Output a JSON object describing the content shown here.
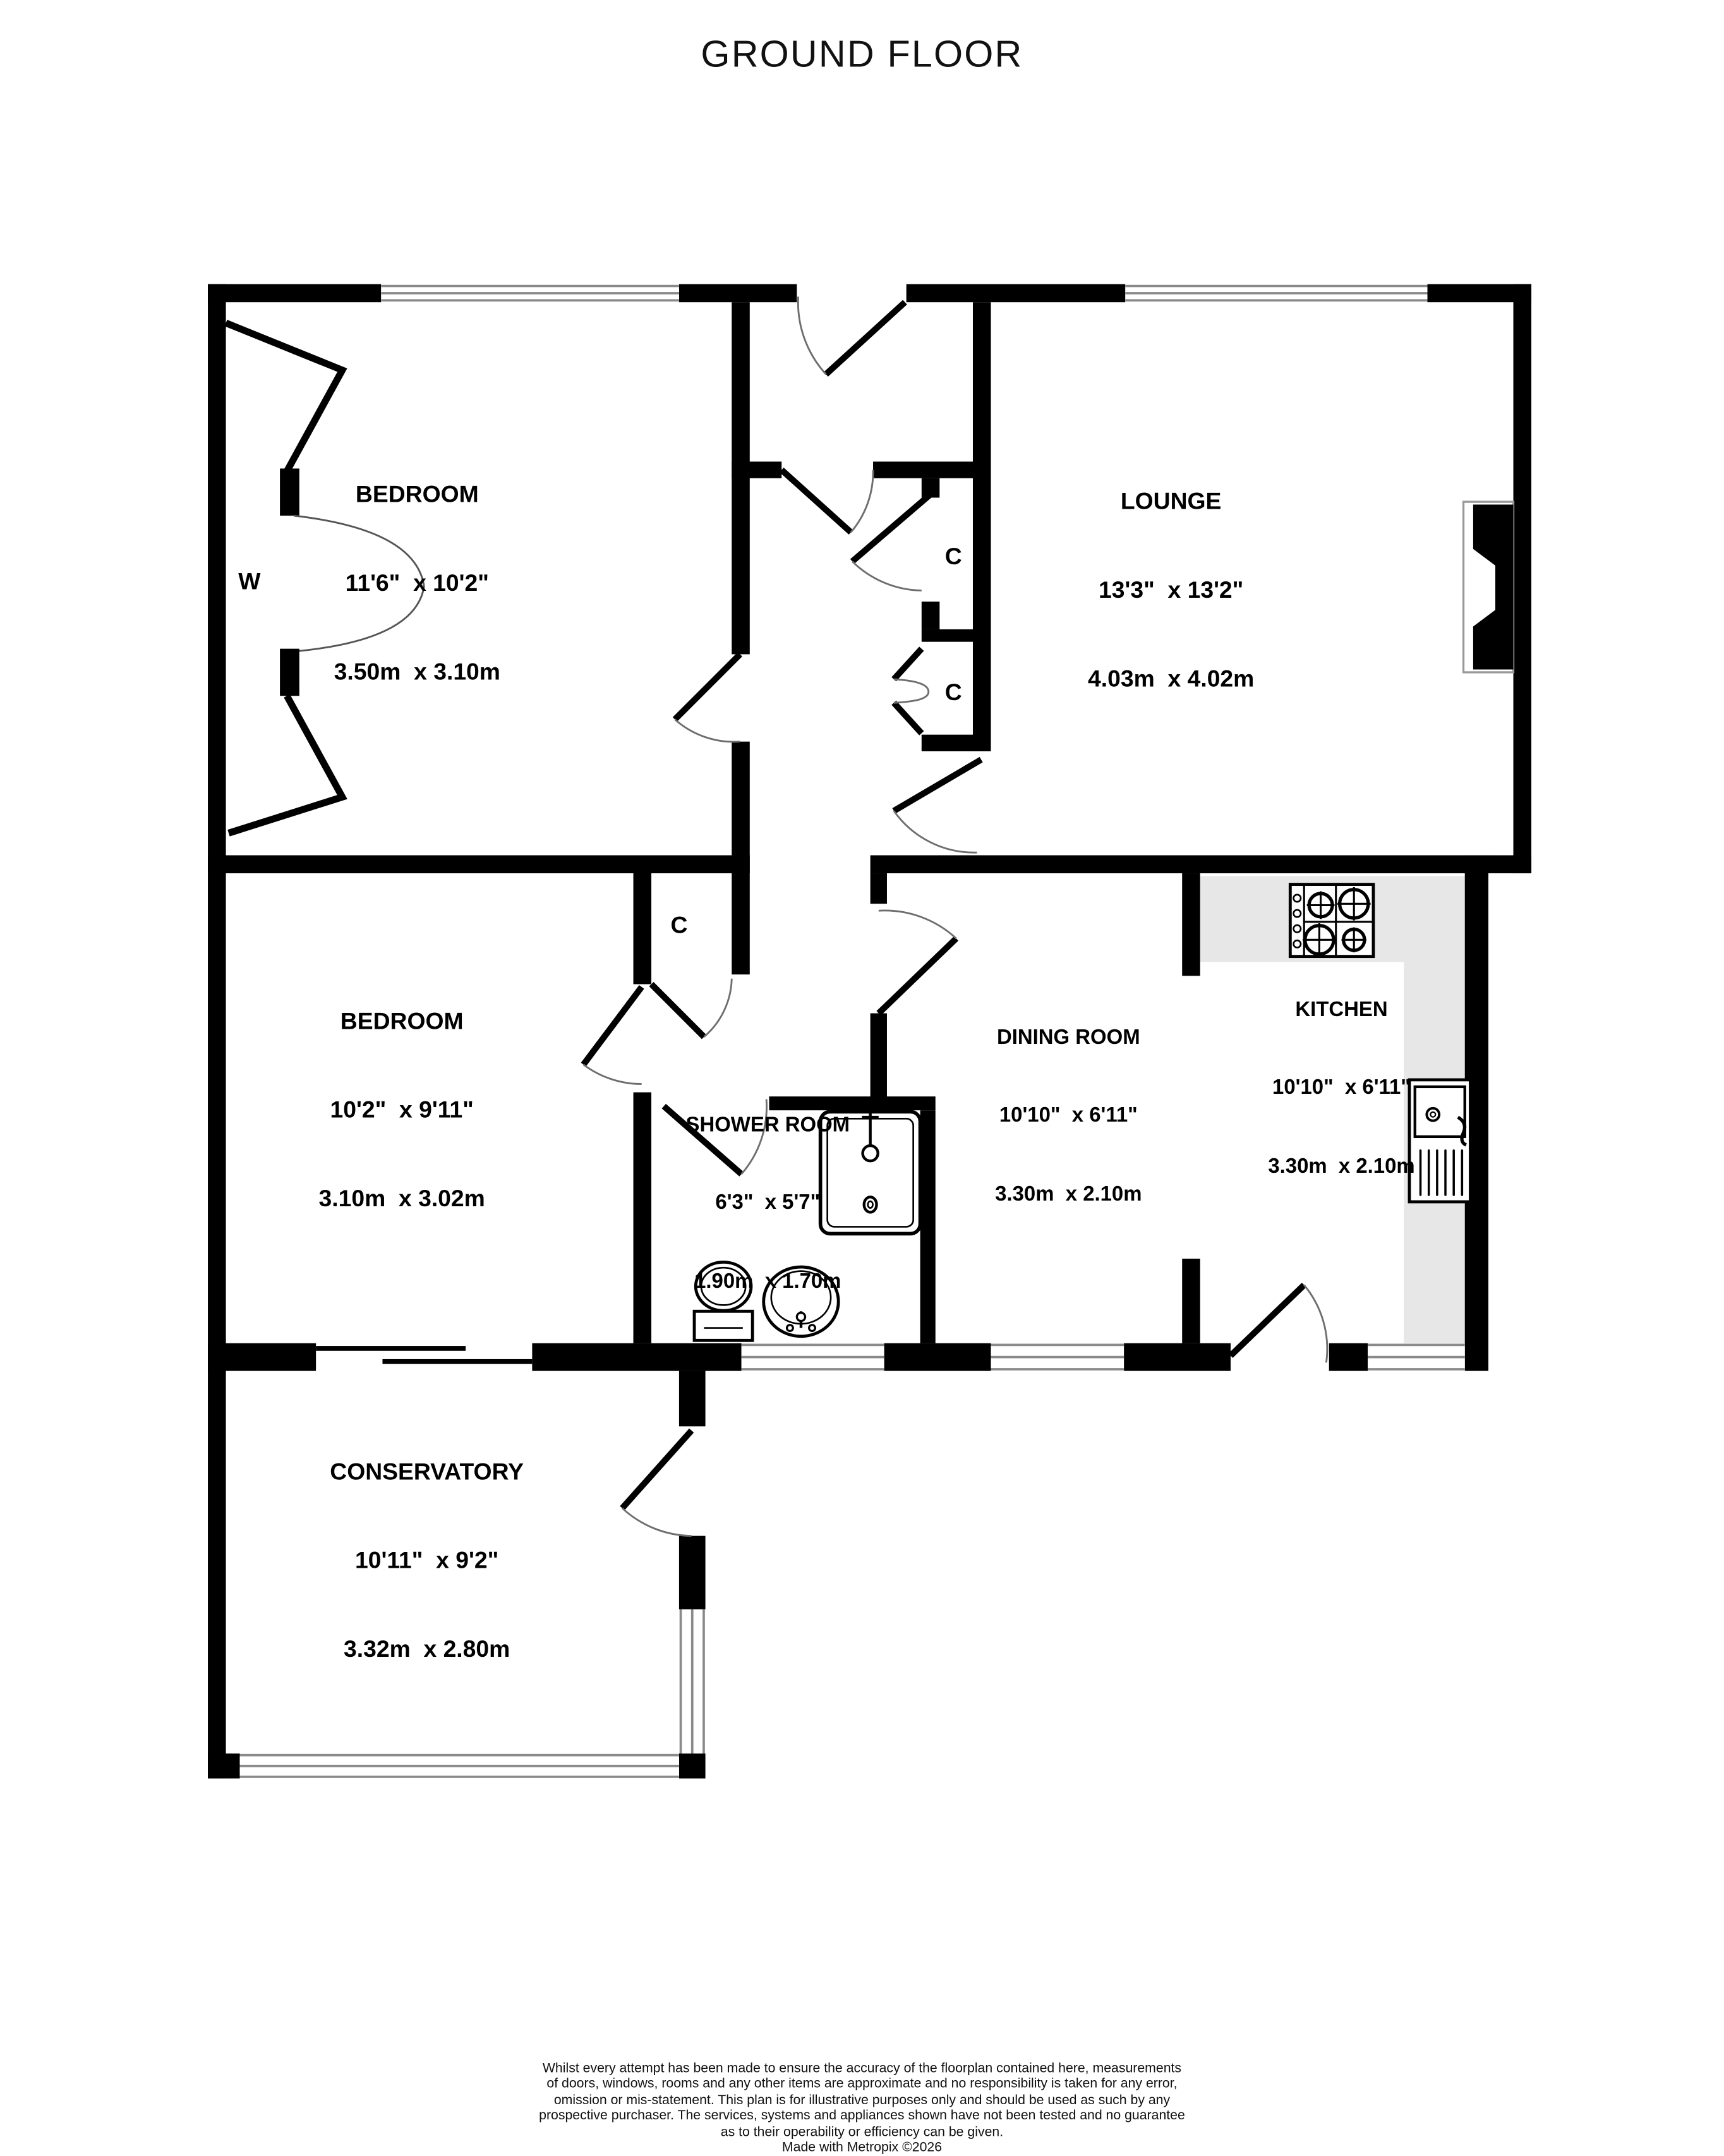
{
  "title": "GROUND FLOOR",
  "colors": {
    "wall": "#000000",
    "counter": "#e7e7e7",
    "window_line": "#8a8a8a",
    "door_arc": "#6e6e6e",
    "background": "#ffffff"
  },
  "markers": {
    "wardrobe": "W",
    "closet": "C"
  },
  "rooms": [
    {
      "name": "BEDROOM",
      "imperial": "11'6\"  x 10'2\"",
      "metric": "3.50m  x 3.10m"
    },
    {
      "name": "LOUNGE",
      "imperial": "13'3\"  x 13'2\"",
      "metric": "4.03m  x 4.02m"
    },
    {
      "name": "BEDROOM",
      "imperial": "10'2\"  x 9'11\"",
      "metric": "3.10m  x 3.02m"
    },
    {
      "name": "SHOWER ROOM",
      "imperial": "6'3\"  x 5'7\"",
      "metric": "1.90m  x 1.70m"
    },
    {
      "name": "DINING ROOM",
      "imperial": "10'10\"  x 6'11\"",
      "metric": "3.30m  x 2.10m"
    },
    {
      "name": "KITCHEN",
      "imperial": "10'10\"  x 6'11\"",
      "metric": "3.30m  x 2.10m"
    },
    {
      "name": "CONSERVATORY",
      "imperial": "10'11\"  x 9'2\"",
      "metric": "3.32m  x 2.80m"
    }
  ],
  "footer": {
    "line1": "Whilst every attempt has been made to ensure the accuracy of the floorplan contained here, measurements",
    "line2": "of doors, windows, rooms and any other items are approximate and no responsibility is taken for any error,",
    "line3": "omission or mis-statement. This plan is for illustrative purposes only and should be used as such by any",
    "line4": "prospective purchaser. The services, systems and appliances shown have not been tested and no guarantee",
    "line5": "as to their operability or efficiency can be given.",
    "credit": "Made with Metropix ©2026"
  }
}
